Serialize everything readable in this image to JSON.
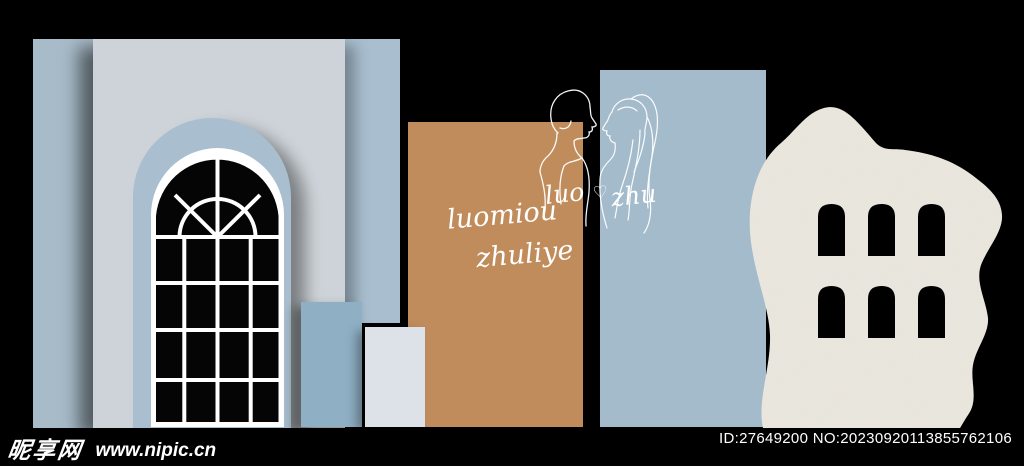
{
  "canvas": {
    "width": 1024,
    "height": 466
  },
  "artwork": {
    "backdrop_script_line1": "luomiou",
    "backdrop_script_line2": "zhuliye",
    "couple_name_left": "luo",
    "couple_name_right": "zhu",
    "heart_glyph": "♡"
  },
  "watermark": {
    "site_name": "昵享网",
    "site_url": "www.nipic.cn",
    "image_id": "ID:27649200 NO:20230920113855762106"
  },
  "palette": {
    "background": "#000000",
    "strip_blue": "#a8bbc9",
    "panel_gray": "#cdd3d8",
    "arch_inset_blue": "#a9bfcf",
    "column_blue": "#a9bfd0",
    "pedestal_blue": "#8fafc4",
    "pedestal_white": "#dce2e8",
    "panel_tan": "#c18c5c",
    "panel_blue": "#a3bbcb",
    "blob_white": "#ebe8e1",
    "window_frame": "#ffffff",
    "line_art": "#ffffff",
    "watermark_text": "#ffffff"
  },
  "icons": {
    "couple_line_art": "bride-and-groom-one-line-drawing",
    "heart": "heart-outline",
    "arched_window": "paned-arch-window",
    "texture_blob": "stucco-blob-with-arch-cutouts"
  }
}
